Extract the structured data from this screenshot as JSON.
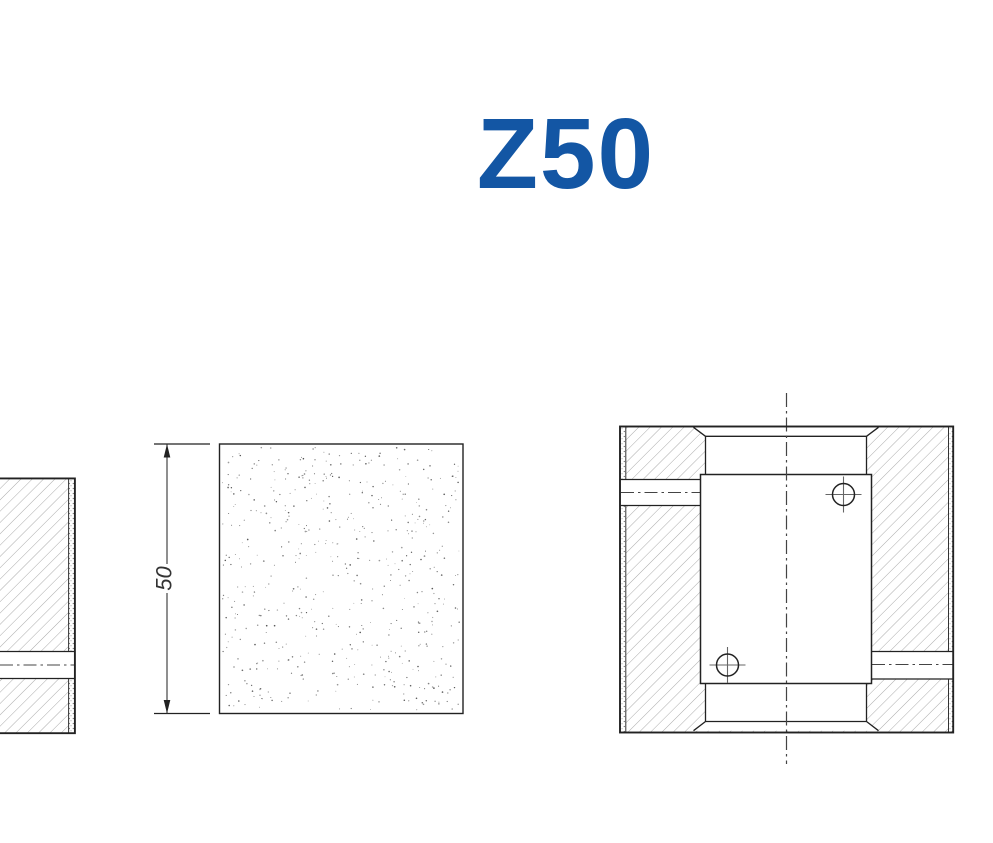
{
  "title": {
    "text": "Z50",
    "color": "#1356a4"
  },
  "front_view": {
    "dimension_label": "50"
  }
}
